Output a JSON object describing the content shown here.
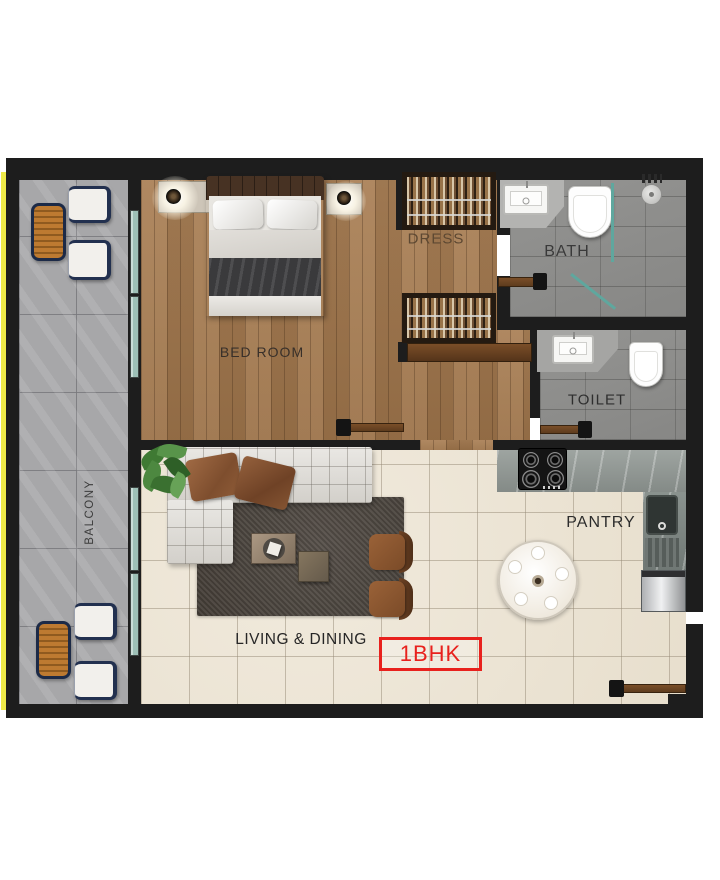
{
  "meta": {
    "title": "1BHK apartment floor plan"
  },
  "rooms": {
    "balcony": {
      "label": "BALCONY"
    },
    "bedroom": {
      "label": "BED ROOM"
    },
    "dress": {
      "label": "DRESS"
    },
    "bath": {
      "label": "BATH"
    },
    "toilet": {
      "label": "TOILET"
    },
    "pantry": {
      "label": "PANTRY"
    },
    "living_dining": {
      "label": "LIVING & DINING"
    }
  },
  "badge": {
    "label": "1BHK",
    "color": "#e8211d"
  },
  "colors": {
    "wall": "#1d1d1d",
    "wood_floor": "#a67a4e",
    "living_tile": "#ece3d1",
    "bath_tile": "#8e8e8c",
    "balcony_tile": "#a7a7a9",
    "door": "#6b4423",
    "glass": "#9dbfb6",
    "accent_red": "#e8211d",
    "edge_strip_yellow": "#eeea49"
  }
}
